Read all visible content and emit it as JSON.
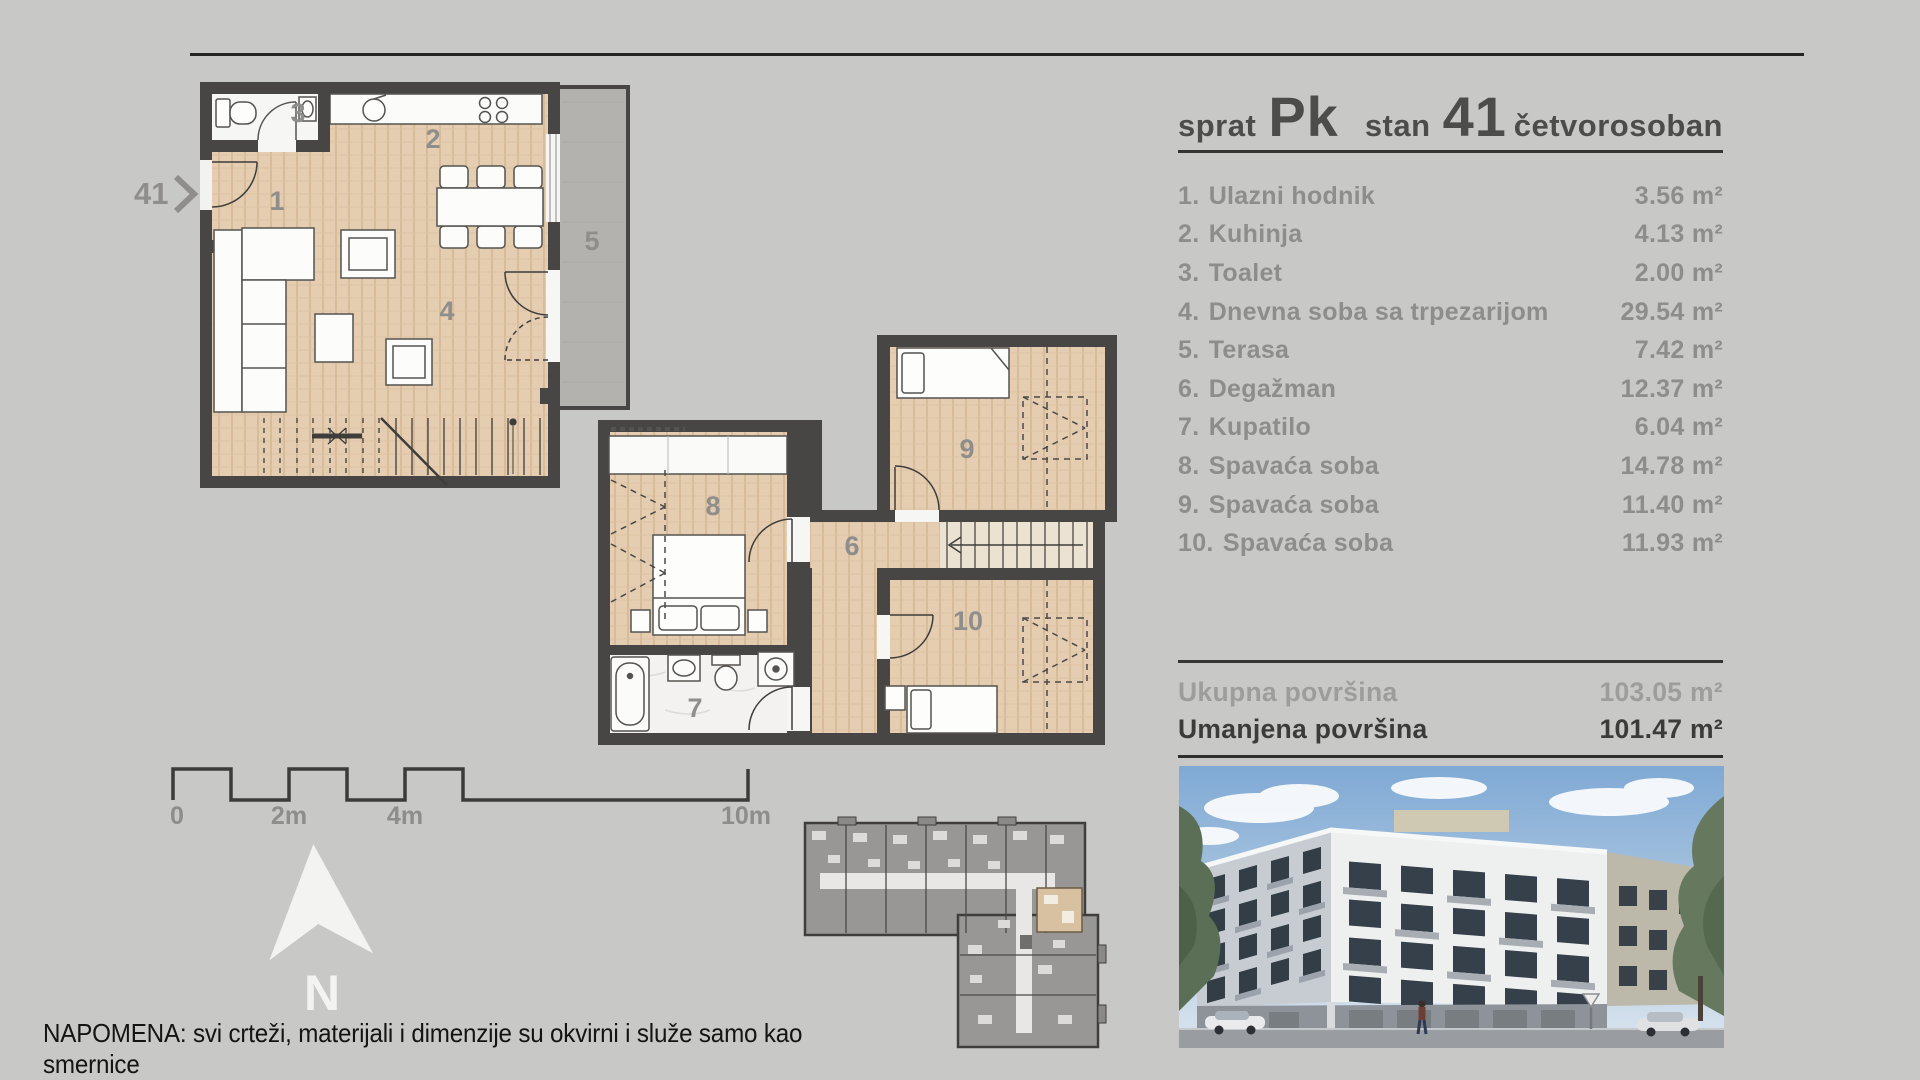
{
  "title": {
    "sprat_label": "sprat",
    "sprat_value": "Pk",
    "stan_label": "stan",
    "stan_value": "41",
    "type": "četvorosoban"
  },
  "rooms": [
    {
      "num": "1.",
      "name": "Ulazni hodnik",
      "area": "3.56 m²"
    },
    {
      "num": "2.",
      "name": "Kuhinja",
      "area": "4.13 m²"
    },
    {
      "num": "3.",
      "name": "Toalet",
      "area": "2.00 m²"
    },
    {
      "num": "4.",
      "name": "Dnevna soba sa trpezarijom",
      "area": "29.54 m²"
    },
    {
      "num": "5.",
      "name": "Terasa",
      "area": "7.42 m²"
    },
    {
      "num": "6.",
      "name": "Degažman",
      "area": "12.37 m²"
    },
    {
      "num": "7.",
      "name": "Kupatilo",
      "area": "6.04 m²"
    },
    {
      "num": "8.",
      "name": "Spavaća soba",
      "area": "14.78 m²"
    },
    {
      "num": "9.",
      "name": "Spavaća soba",
      "area": "11.40 m²"
    },
    {
      "num": "10.",
      "name": "Spavaća soba",
      "area": "11.93 m²"
    }
  ],
  "totals": {
    "gross_label": "Ukupna površina",
    "gross_value": "103.05 m²",
    "net_label": "Umanjena površina",
    "net_value": "101.47 m²"
  },
  "scalebar": {
    "labels": [
      "0",
      "2m",
      "4m",
      "10m"
    ]
  },
  "north": {
    "label": "N"
  },
  "entry": {
    "unit": "41"
  },
  "plan": {
    "upper_numbers": [
      "1",
      "2",
      "3",
      "4",
      "5"
    ],
    "lower_numbers": [
      "6",
      "7",
      "8",
      "9",
      "10"
    ]
  },
  "note": "NAPOMENA: svi crteži, materijali i dimenzije su okvirni i služe samo kao smernice",
  "colors": {
    "wall": "#474645",
    "wood_floor": "#e4cdb0",
    "terrace": "#b3b2af",
    "background": "#c8c8c6",
    "text_gray": "#8d8d8b",
    "text_dark": "#3b3b3a"
  }
}
